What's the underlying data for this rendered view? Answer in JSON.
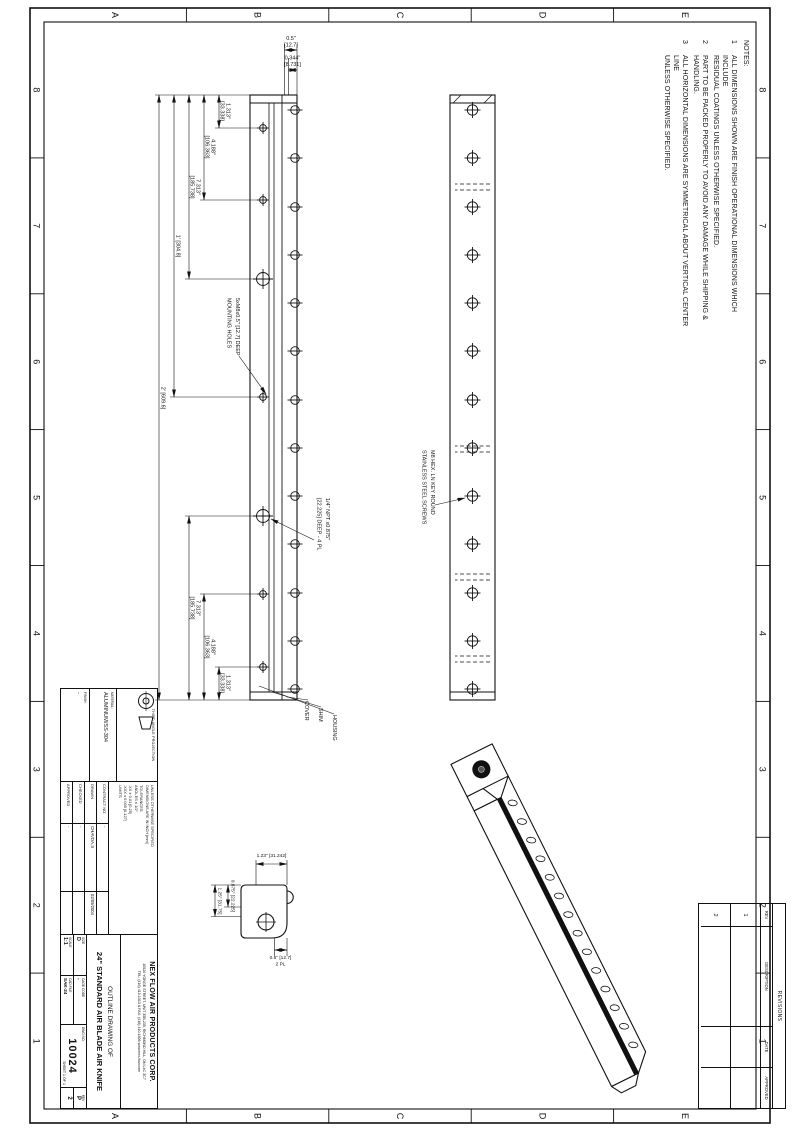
{
  "sheet": {
    "zones_cols": [
      "8",
      "7",
      "6",
      "5",
      "4",
      "3",
      "2",
      "1"
    ],
    "zones_rows": [
      "E",
      "D",
      "C",
      "B",
      "A"
    ]
  },
  "notes": {
    "heading": "NOTES:",
    "items": [
      {
        "num": "1",
        "line1": "ALL DIMENSIONS SHOWN ARE FINISH OPERATIONAL DIMENSIONS WHICH INCLUDE",
        "line2": "RESIDUAL COATINGS UNLESS OTHERWISE SPECIFIED."
      },
      {
        "num": "2",
        "line1": "PART TO BE PACKED PROPERLY TO AVOID ANY DAMAGE WHILE SHIPPING & HANDLING.",
        "line2": ""
      },
      {
        "num": "3",
        "line1": "ALL HORIZONTAL DIMENSIONS ARE SYMMETRICAL ABOUT VERTICAL CENTER LINE",
        "line2": "UNLESS OTHERWISE SPECIFIED."
      }
    ]
  },
  "dims": {
    "d1313_in": "1.313\"",
    "d1313_mm": "[33.338]",
    "d4188_in": "4.188\"",
    "d4188_mm": "[106.363]",
    "d7313_in": "7.313\"",
    "d7313_mm": "[185.738]",
    "d12": "1' [304.8]",
    "d24": "2' [609.6]",
    "d05_in": "0.5\"",
    "d05_mm": "[12.7]",
    "d0344_in": "0.344\"",
    "d0344_mm": "[8.731]"
  },
  "callouts": {
    "mounting_1": "5xM8x0.5\" [12.7] DEEP",
    "mounting_2": "MOUNTING HOLES",
    "npt_1": "1/4\" NPT x0.875\"",
    "npt_2": "[22.225] DEEP - 4 PL",
    "screws_1": "M8 HEX. LN KEY ROUND",
    "screws_2": "STAINLESS STEEL SCREWS",
    "cover": "COVER",
    "shim": "SHIM",
    "housing": "HOUSING"
  },
  "section": {
    "s1": "1.23\" [31.242]",
    "s2": "0.875\" [22.225]",
    "s3": "1.25\" [31.75]",
    "s4": "0.5\" [12.7]",
    "s4b": "2 PL"
  },
  "revisions": {
    "title": "REVISIONS",
    "headers": [
      "REV",
      "DESCRIPTION",
      "DATE",
      "APPROVED"
    ],
    "rows": [
      {
        "rev": "1",
        "description": "",
        "date": "",
        "approved": ""
      },
      {
        "rev": "2",
        "description": "",
        "date": "",
        "approved": ""
      }
    ]
  },
  "title_block": {
    "projection_label": "THIRD ANGLE PROJECTION",
    "material_label": "MATERIAL:",
    "material": "ALUMINUM/SS-304",
    "finish_label": "FINISH:",
    "finish": "-",
    "tolerances": [
      "UNLESS OTHERWISE SPECIFIED",
      "DIMENSIONS ARE IN INCH [mm]",
      "TOLERANCES:",
      "ANGLES ± 1/2°",
      ".XX ± 0.01 [0.25]",
      ".XXX ± 0.005 [0.127]",
      "LIMITS"
    ],
    "sig": [
      {
        "l": "CONTRACT NO.",
        "v": "-",
        "d": ""
      },
      {
        "l": "DRAWN",
        "v": "CHAVDA.S",
        "d": "02/09/2004"
      },
      {
        "l": "CHECKED",
        "v": "-",
        "d": ""
      },
      {
        "l": "APPROVED",
        "v": "-",
        "d": ""
      }
    ],
    "company": "NEX FLOW AIR PRODUCTS CORP.",
    "address": "10520 YONGE STREET, UNIT 35B-235, RICHMOND HILL, ON L4C 3C7",
    "phone": "TEL: (416) 410-1313 & FAX: (416) 410-1806   www.nex-flow.com",
    "title1": "OUTLINE DRAWING OF",
    "title2": "24\" STANDARD AIR BLADE AIR KNIFE",
    "size_label": "SIZE",
    "size": "D",
    "scale_label": "SCALE",
    "scale": "1:1",
    "cage_label": "CAGE CODE",
    "cage": "-",
    "cad_label": "CAD FILE",
    "cad": "SAK-24",
    "dwg_label": "DWG NO.",
    "dwg": "10024",
    "sheet_label": "SHEET",
    "sheet": "1 OF 1",
    "rev_label": "REV",
    "rev_top": "P",
    "rev_bottom": "2"
  }
}
